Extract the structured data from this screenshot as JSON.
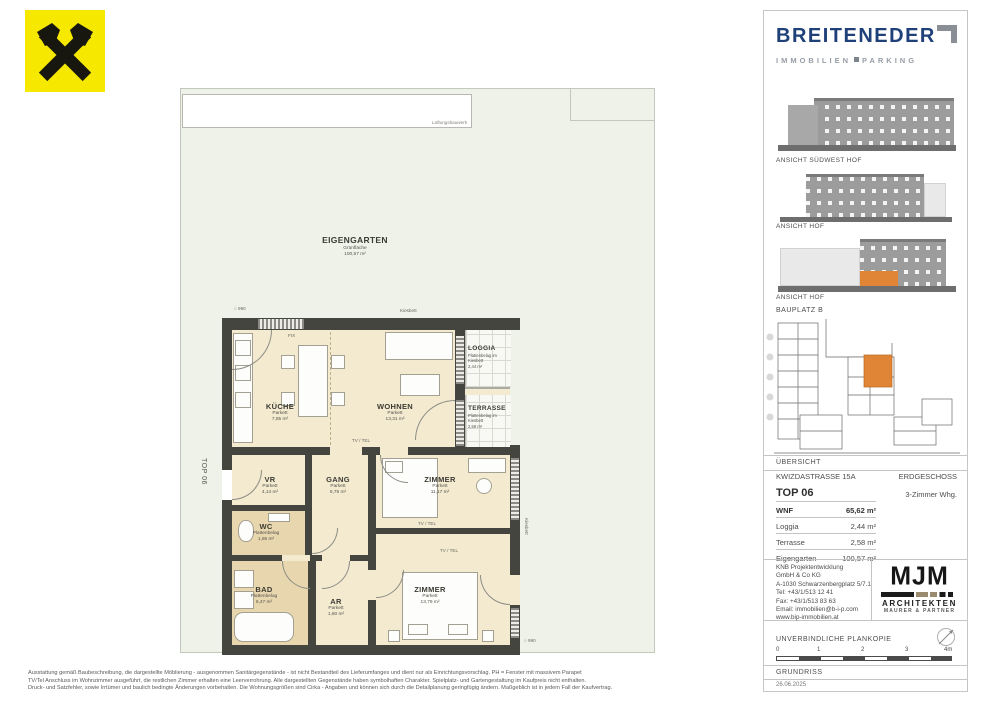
{
  "plan": {
    "top_label": "TOP 06",
    "garden": {
      "title": "EIGENGARTEN",
      "subtitle": "Grünfläche",
      "area": "100,57 m²",
      "structure": "Lüftungsbauwerk"
    },
    "rooms": [
      {
        "name": "KÜCHE",
        "floor": "Parkett",
        "area": "7,85 m²"
      },
      {
        "name": "WOHNEN",
        "floor": "Parkett",
        "area": "13,31 m²"
      },
      {
        "name": "LOGGIA",
        "floor": "Plattenbelag im Kiesbett",
        "area": "2,44 m²"
      },
      {
        "name": "TERRASSE",
        "floor": "Plattenbelag im Kiesbett",
        "area": "2,58 m²"
      },
      {
        "name": "VR",
        "floor": "Parkett",
        "area": "4,14 m²"
      },
      {
        "name": "GANG",
        "floor": "Parkett",
        "area": "5,75 m²"
      },
      {
        "name": "ZIMMER",
        "floor": "Parkett",
        "area": "11,17 m²"
      },
      {
        "name": "WC",
        "floor": "Plattenbelag",
        "area": "1,95 m²"
      },
      {
        "name": "BAD",
        "floor": "Plattenbelag",
        "area": "6,47 m²"
      },
      {
        "name": "AR",
        "floor": "Parkett",
        "area": "1,60 m²"
      },
      {
        "name": "ZIMMER",
        "floor": "Parkett",
        "area": "13,79 m²"
      }
    ],
    "annotations": {
      "tv_tel": "TV / TEL",
      "fix": "FIX",
      "kiesbett": "Kiesbett",
      "marker": "○ 990"
    }
  },
  "sidebar": {
    "brand": {
      "title": "BREITENEDER",
      "subtitle_left": "IMMOBILIEN",
      "subtitle_right": "PARKING"
    },
    "elevation_labels": [
      "ANSICHT SÜDWEST HOF",
      "ANSICHT HOF",
      "ANSICHT HOF"
    ],
    "bauplatz": "BAUPLATZ  B",
    "uebersicht": "ÜBERSICHT",
    "address": "KWIZDASTRASSE 15A",
    "floor": "ERDGESCHOSS",
    "unit": "TOP 06",
    "unit_type": "3-Zimmer Whg.",
    "metrics": [
      {
        "label": "WNF",
        "value": "65,62 m²"
      },
      {
        "label": "Loggia",
        "value": "2,44 m²"
      },
      {
        "label": "Terrasse",
        "value": "2,58 m²"
      },
      {
        "label": "Eigengarten",
        "value": "100,57 m²"
      }
    ],
    "contact_lines": [
      "KNB Projektentwicklung",
      "GmbH & Co KG",
      "A-1030 Schwarzenbergplatz 5/7.1",
      "Tel: +43/1/513 12 41",
      "Fax: +43/1/513 83 63",
      "Email: immobilien@b-i-p.com",
      "www.bip-immobilien.at"
    ],
    "architect": {
      "monogram": "MJM",
      "line1": "ARCHITEKTEN",
      "line2": "MAURER & PARTNER"
    },
    "plankopie": "UNVERBINDLICHE PLANKOPIE",
    "scale_ticks": [
      "0",
      "1",
      "2",
      "3",
      "4m"
    ],
    "grundriss": "GRUNDRISS",
    "date": "26.06.2025"
  },
  "footer": {
    "lines": [
      "Ausstattung gemäß Baubeschreibung, die dargestellte Möblierung - ausgenommen Sanitärgegenstände - ist nicht Bestandteil des Lieferumfanges und dient nur als Einrichtungsvorschlag. PH = Fenster mit massivem Parapet",
      "TV/Tel Anschluss im Wohnzimmer ausgeführt, die restlichen Zimmer erhalten eine Leerverrohrung. Alle dargestellten Gegenstände haben symbolhaften Charakter. Spielplatz- und Gartengestaltung im Kaufpreis nicht enthalten.",
      "Druck- und Satzfehler, sowie Irrtümer und baulich bedingte Änderungen vorbehalten. Die Wohnungsgrößen sind Cirka - Angaben und können sich durch die Detailplanung geringfügig ändern. Maßgeblich ist in jedem Fall der Kaufvertrag."
    ]
  },
  "colors": {
    "accent_orange": "#e08435",
    "brand_blue": "#20407a",
    "garden_green": "#eef2e9",
    "room_beige": "#f3ead0",
    "wet_tan": "#e8d6ae",
    "wall": "#45453f"
  }
}
